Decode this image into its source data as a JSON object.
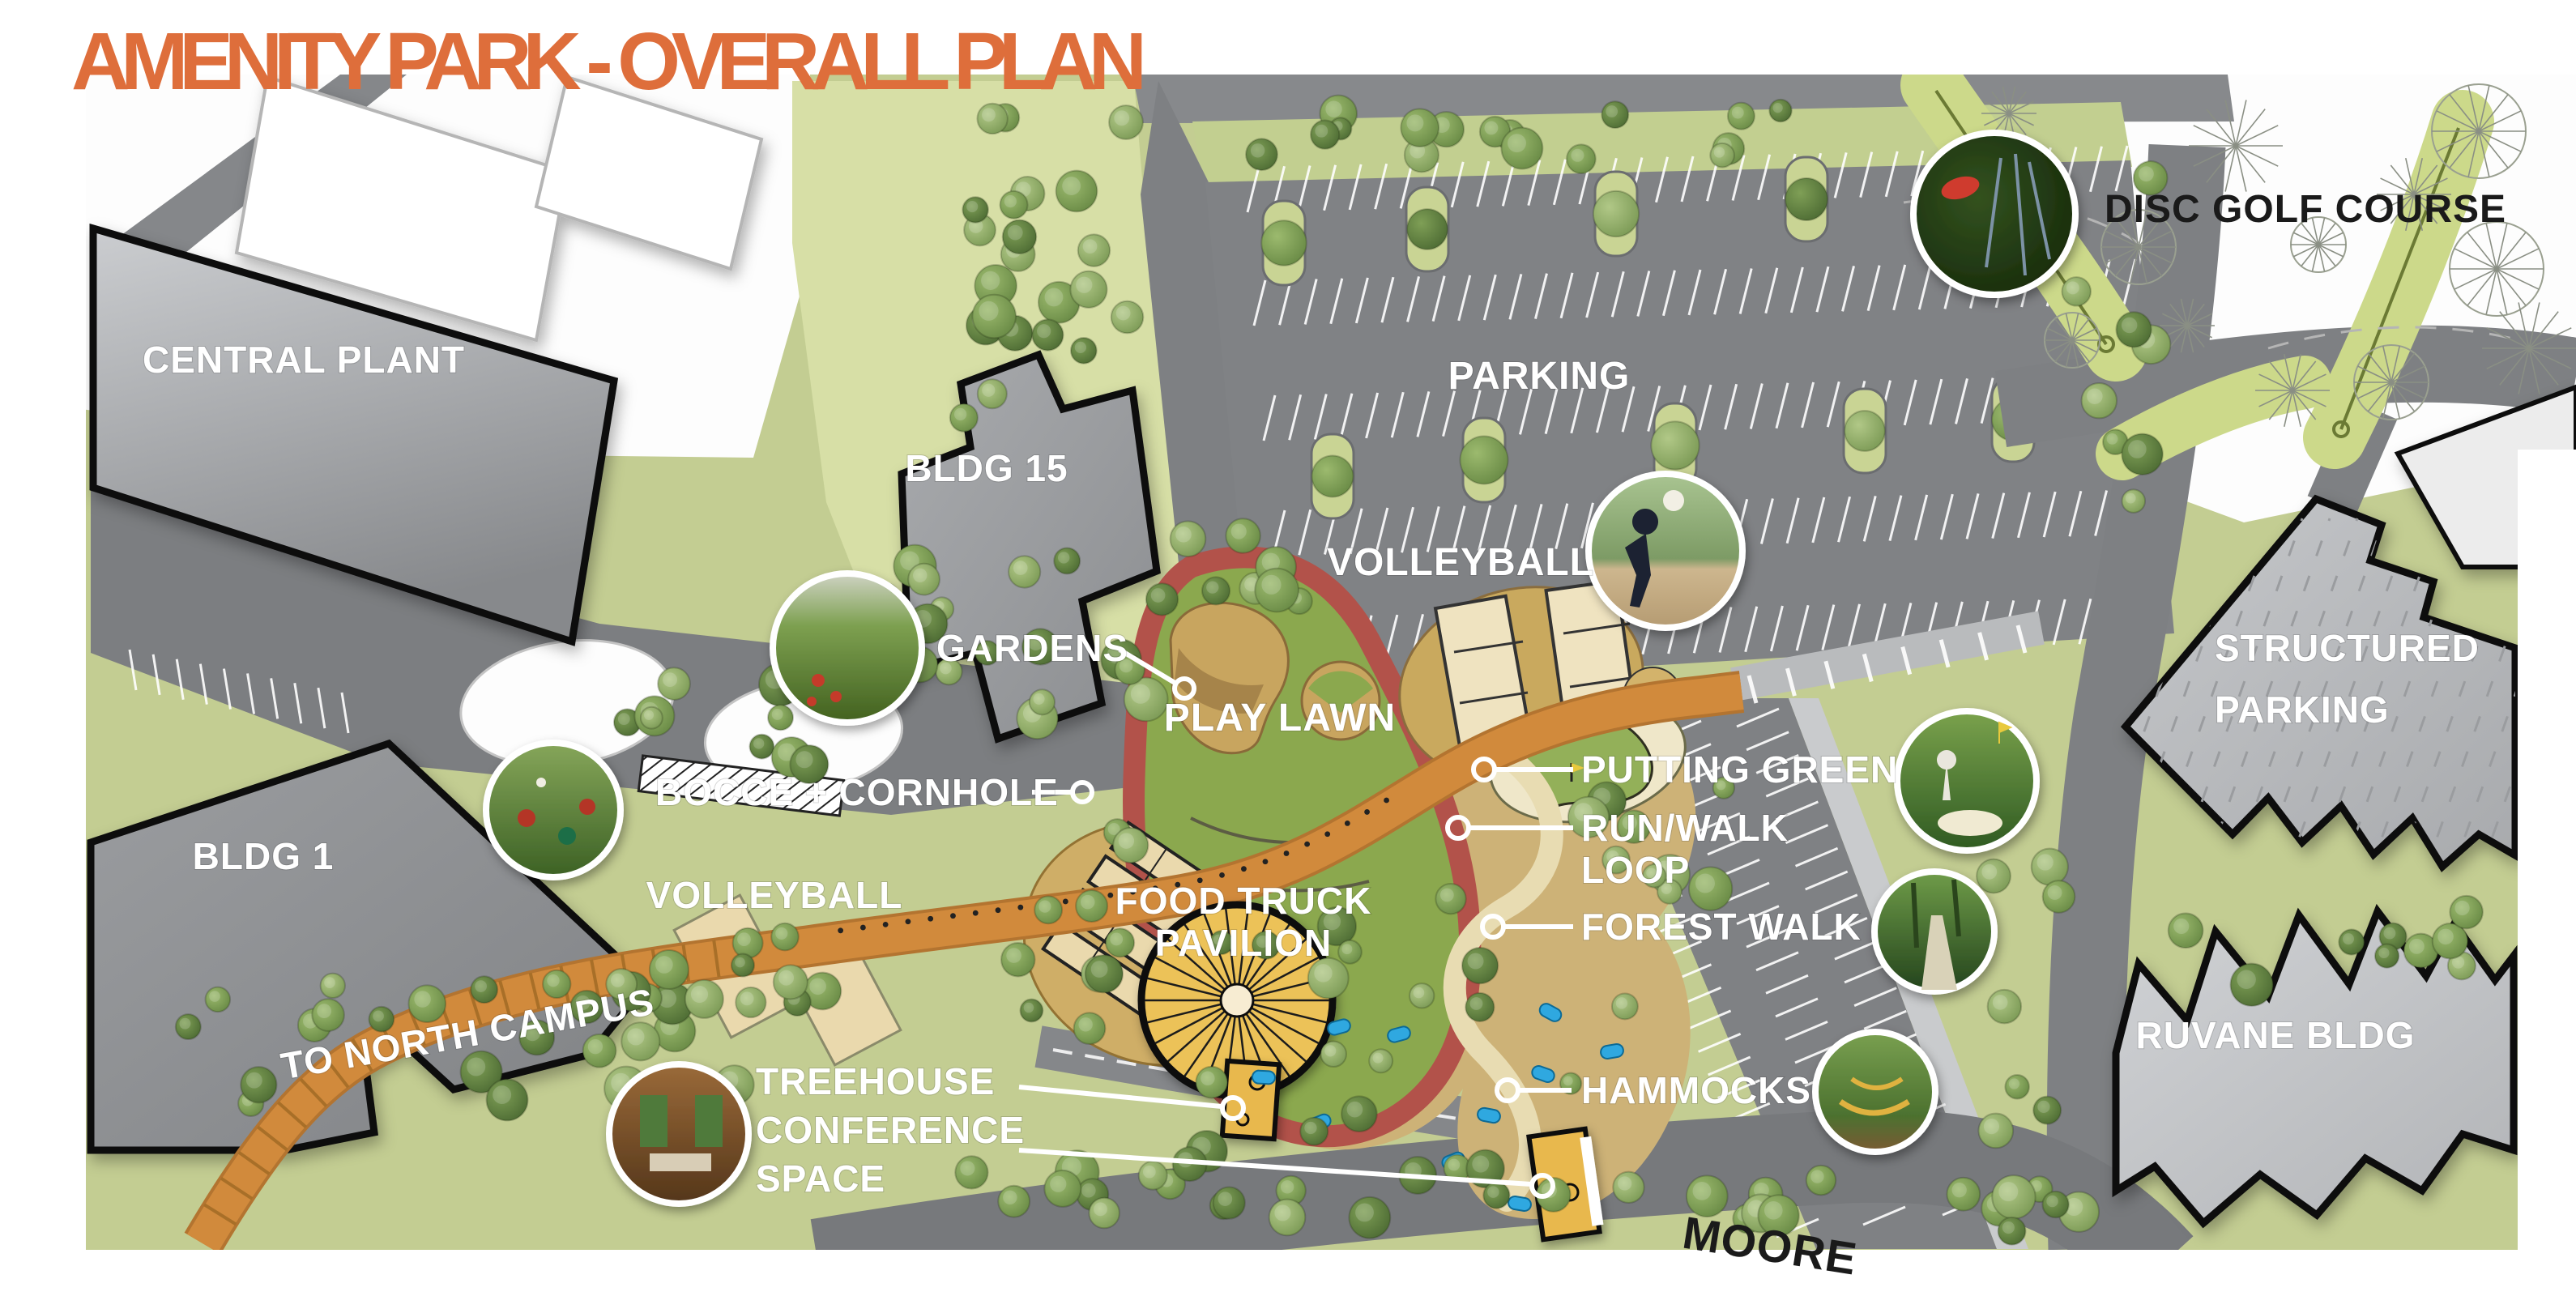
{
  "title": "AMENITY PARK - OVERALL PLAN",
  "labels": {
    "central_plant": "CENTRAL PLANT",
    "bldg_15": "BLDG 15",
    "bldg_1": "BLDG 1",
    "parking": "PARKING",
    "disc_golf_course": "DISC GOLF COURSE",
    "volleyball_north": "VOLLEYBALL",
    "volleyball_south": "VOLLEYBALL",
    "gardens": "GARDENS",
    "play_lawn": "PLAY LAWN",
    "bocce_cornhole": "BOCCE + CORNHOLE",
    "food_truck_1": "FOOD TRUCK",
    "food_truck_2": "PAVILION",
    "putting_green": "PUTTING GREEN",
    "run_walk_1": "RUN/WALK",
    "run_walk_2": "LOOP",
    "forest_walk": "FOREST WALK",
    "hammocks": "HAMMOCKS",
    "structured_parking_1": "STRUCTURED",
    "structured_parking_2": "PARKING",
    "ruvane_bldg": "RUVANE BLDG",
    "to_north_campus": "TO NORTH CAMPUS",
    "treehouse_1": "TREEHOUSE",
    "treehouse_2": "CONFERENCE",
    "treehouse_3": "SPACE",
    "moore_road": "MOORE"
  },
  "photos": {
    "disc_golf": "disc-golf-basket-photo",
    "volleyball": "volleyball-players-photo",
    "gardens": "community-garden-photo",
    "bocce": "bocce-balls-photo",
    "putting_green": "golfer-putting-photo",
    "forest_walk": "forest-boardwalk-photo",
    "hammocks": "hammock-grove-photo",
    "treehouse": "treehouse-conference-room-photo"
  },
  "colors": {
    "accent_orange": "#de6e3b",
    "label_white": "#ffffff",
    "label_black": "#1a1a1a",
    "path_orange": "#d18a3c",
    "loop_red": "#b2524a",
    "lawn_green": "#8ba84e",
    "field_green": "#c3cd92",
    "road_gray": "#7e8083",
    "building_gray": "#97999c"
  }
}
